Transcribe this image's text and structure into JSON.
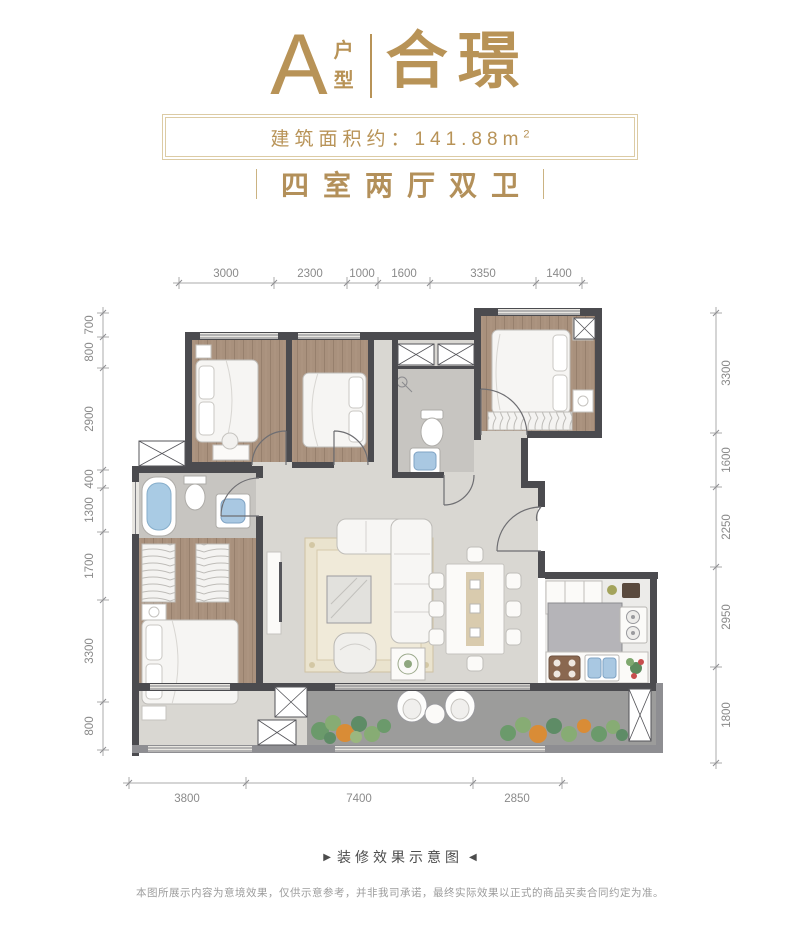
{
  "header": {
    "type_letter": "A",
    "type_label_chars": [
      "户",
      "型"
    ],
    "name": "合璟",
    "area_text": "建筑面积约：141.88m",
    "area_superscript": "2",
    "layout_text": "四室两厅双卫"
  },
  "dimensions": {
    "top": [
      "3000",
      "2300",
      "1000",
      "1600",
      "3350",
      "1400"
    ],
    "left": [
      "700",
      "800",
      "2900",
      "400",
      "1300",
      "1700",
      "3300",
      "800"
    ],
    "right": [
      "3300",
      "1600",
      "2250",
      "2950",
      "1800"
    ],
    "bottom": [
      "3800",
      "7400",
      "2850"
    ]
  },
  "footer": {
    "caption_arrow_left": "▶",
    "caption": "装修效果示意图",
    "caption_arrow_right": "◀",
    "disclaimer": "本图所展示内容为意境效果，仅供示意参考，并非我司承诺，最终实际效果以正式的商品买卖合同约定为准。"
  },
  "colors": {
    "gold": "#B89357",
    "frame_tan": "#DCCBA4",
    "wall_dark": "#4B4B4F",
    "wall_gray": "#8E8E92",
    "wood_floor": "#A9917D",
    "tile_floor": "#D9D7D2",
    "bath_floor": "#C7C5C1",
    "balcony_floor": "#9C9C9B",
    "water_blue": "#A9C8E2",
    "plant_green": "#6B9A6B",
    "plant_orange": "#D98C36",
    "dim_text": "#8A8A8A"
  }
}
